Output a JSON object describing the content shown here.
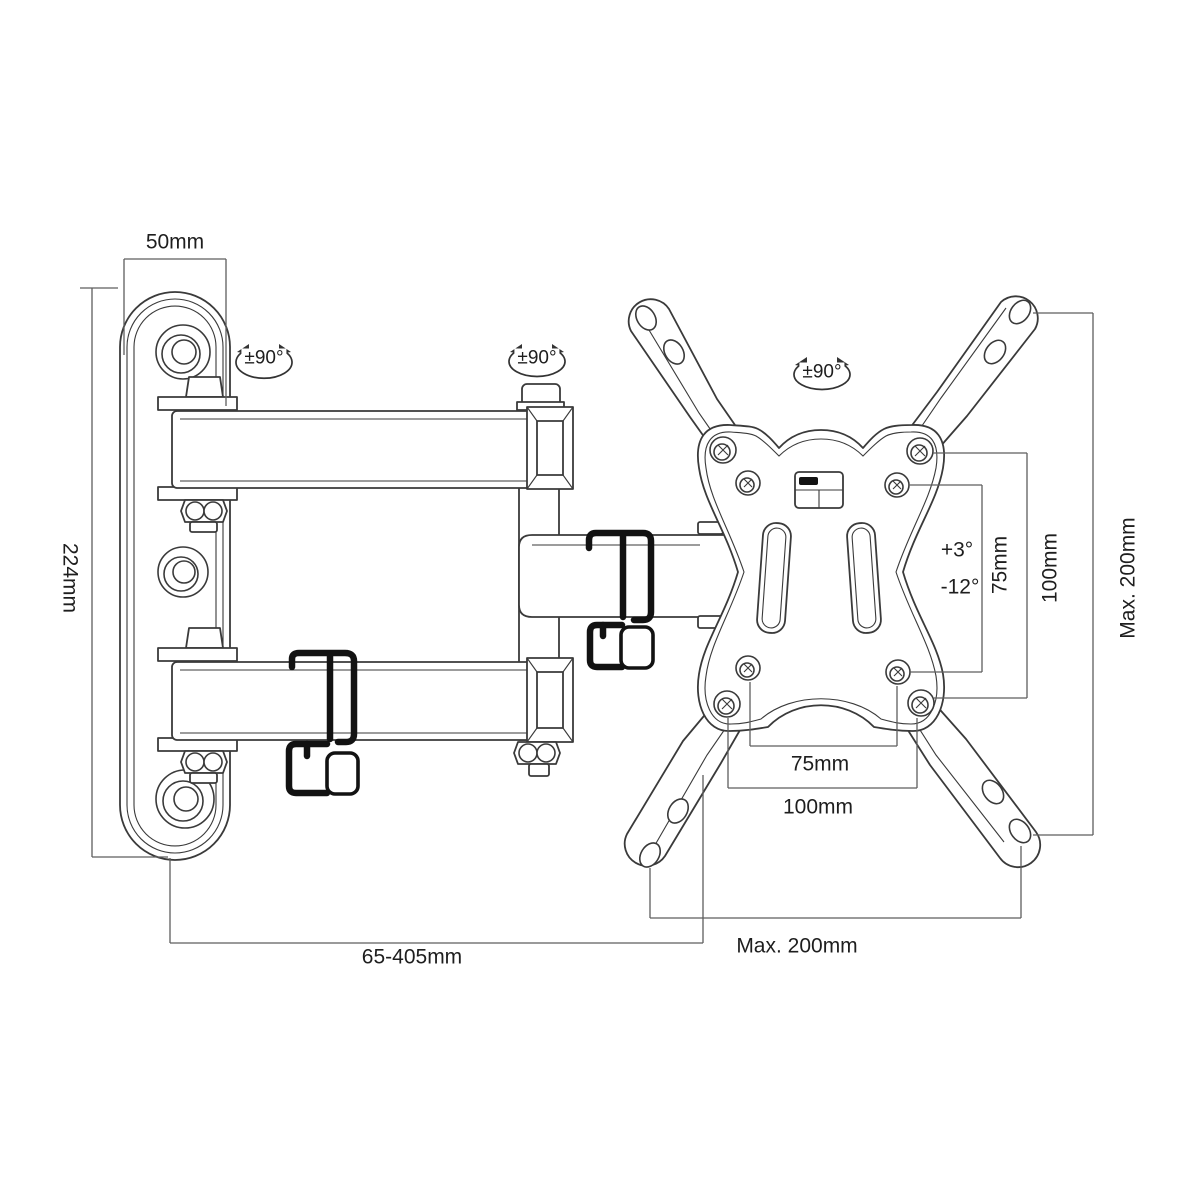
{
  "drawing": {
    "type": "technical-dimension-diagram",
    "subject": "Full-motion TV wall mount bracket with articulating arm and VESA plate",
    "labels": {
      "wall_plate_width": "50mm",
      "wall_plate_height": "224mm",
      "swivel_left": "±90°",
      "swivel_middle": "±90°",
      "swivel_right": "±90°",
      "tilt_up": "+3°",
      "tilt_down": "-12°",
      "vesa_vertical_75": "75mm",
      "vesa_vertical_100": "100mm",
      "vesa_max_vertical": "Max. 200mm",
      "vesa_horizontal_75": "75mm",
      "vesa_horizontal_100": "100mm",
      "extension_range": "65-405mm",
      "vesa_max_horizontal": "Max. 200mm"
    },
    "colors": {
      "background": "#ffffff",
      "part_line": "#3a3a3a",
      "dimension_line": "#5e5e5e",
      "clip": "#121212",
      "text": "#1e1e1e"
    }
  }
}
